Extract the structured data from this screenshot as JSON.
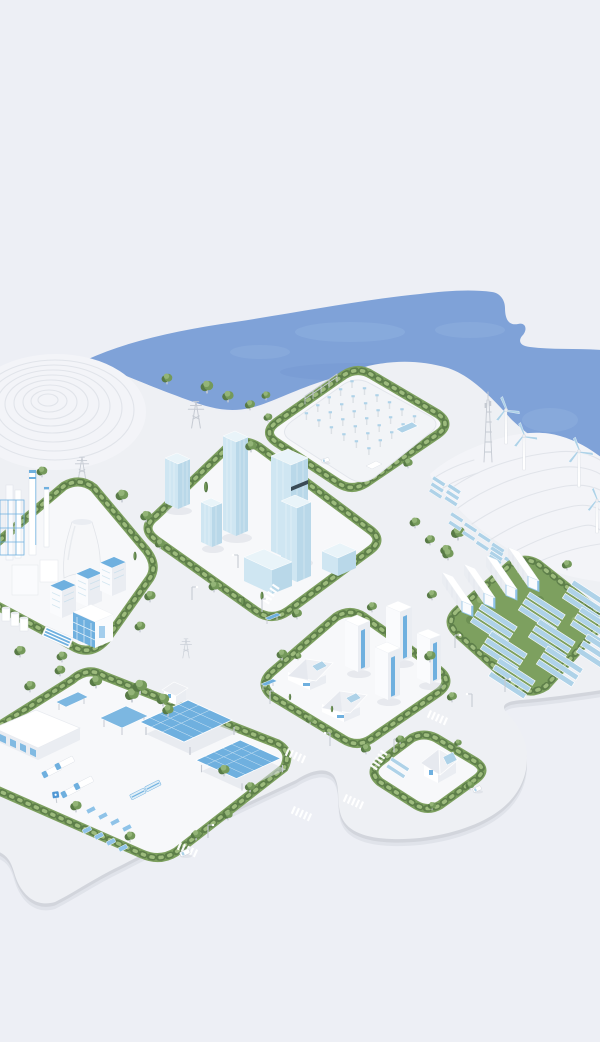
{
  "scene": {
    "illustration": "isometric-3d-smart-energy-city-model",
    "water_body": "bay-with-cove",
    "terraced_hills": 2,
    "wind_turbines": 4,
    "telecom_masts": 1,
    "transmission_pylons": 3,
    "bus_shelters": 2,
    "crosswalks": 7,
    "vehicles_on_road": 3,
    "districts": [
      {
        "name": "substation-yard",
        "equipment_rows": 5,
        "gantry": 1,
        "solar_pads": 1
      },
      {
        "name": "downtown-towers",
        "glass_towers": 5,
        "podium_blocks": 2
      },
      {
        "name": "industrial-plant",
        "chimneys": 2,
        "cooling_towers": 1,
        "blue_roof_blocks": 3,
        "storage_tanks": 3
      },
      {
        "name": "solar-battery-farm",
        "battery_containers": 4,
        "solar_array_cells": 9
      },
      {
        "name": "residential-block",
        "apartment_towers": 4,
        "villas": 2
      },
      {
        "name": "logistics-depot",
        "solar_canopies": 2,
        "trucks": 4,
        "buses": 2,
        "parked_vans": 8,
        "warehouse": 1
      },
      {
        "name": "suburban-house-lot",
        "houses": 1,
        "ground_solar_strips": 2
      }
    ],
    "hillside_solar_clusters": 3
  },
  "colors": {
    "bg": "#edeff5",
    "water": "#7fa2d8",
    "waterlight": "#93b3e2",
    "waterdeep": "#6f93cc",
    "plate": "#eef0f4",
    "plateside": "#d2d5dc",
    "plateshadow": "#dde0e7",
    "plot": "#f7f8fa",
    "terrace": "#f3f4f8",
    "terrline": "#e1e4ea",
    "hedge": "#7da05f",
    "hedgedark": "#5e7f4a",
    "hedgelight": "#9dbb7d",
    "tree": "#74995a",
    "treedark": "#587a46",
    "treelight": "#93b477",
    "white": "#ffffff",
    "facelight": "#fafbfd",
    "facemid": "#eaedf2",
    "facedark": "#d9dde4",
    "glass": "#cfe6f2",
    "glassdark": "#b9d8e9",
    "glasstop": "#e9f4f9",
    "accent": "#6fb0df",
    "accentdeep": "#4f97d4",
    "panel": "#aed2e8",
    "panellight": "#8fc3e8",
    "steel": "#c6cbd3",
    "darkband": "#3a4a55",
    "shadow": "#c9cdd6"
  }
}
